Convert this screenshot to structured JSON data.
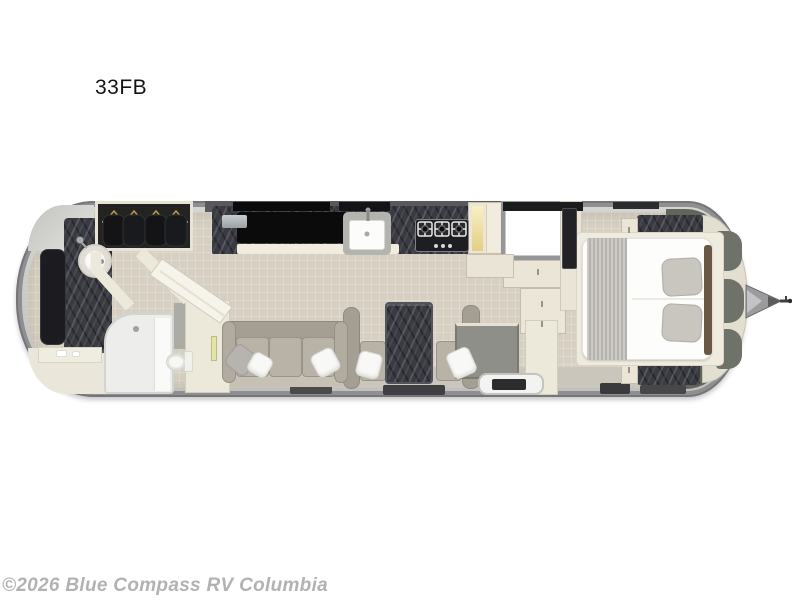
{
  "title": "33FB",
  "watermark": "©2026 Blue Compass RV Columbia",
  "floorplan": {
    "model": "33FB",
    "view": "travel-trailer-floorplan-top-view",
    "features": [
      "hitch",
      "front-storage-lockers",
      "queen-bed",
      "bed-runner",
      "bed-pillows",
      "nightstand-top",
      "nightstand-bottom",
      "bedroom-tv",
      "bedroom-doorway",
      "refrigerator",
      "pantry",
      "cooktop",
      "kitchen-sink",
      "galley-counter",
      "coffee-maker",
      "overhead-cabinets",
      "entry-step",
      "entry-cabinet",
      "dinette-table",
      "dinette-benches",
      "sofa",
      "throw-pillows",
      "floor-mats",
      "wardrobe-closet",
      "hanging-clothes",
      "vanity-sink",
      "rear-tv",
      "shower",
      "toilet",
      "bathroom-counter"
    ],
    "colors": {
      "shell": "#8f8f91",
      "shell_highlight": "#c9c9c7",
      "floor": "#d6cfc2",
      "walls": "#ece8da",
      "counter_marble": "#3a3b42",
      "upholstery": "#b9b2a6",
      "mattress": "#fdfdfc",
      "appliance_black": "#0b0b0b",
      "olive_storage": "#61665d",
      "pantry_glow": "#f2e6a8",
      "title_text": "#141414",
      "watermark_text": "#b2b2b2"
    }
  }
}
